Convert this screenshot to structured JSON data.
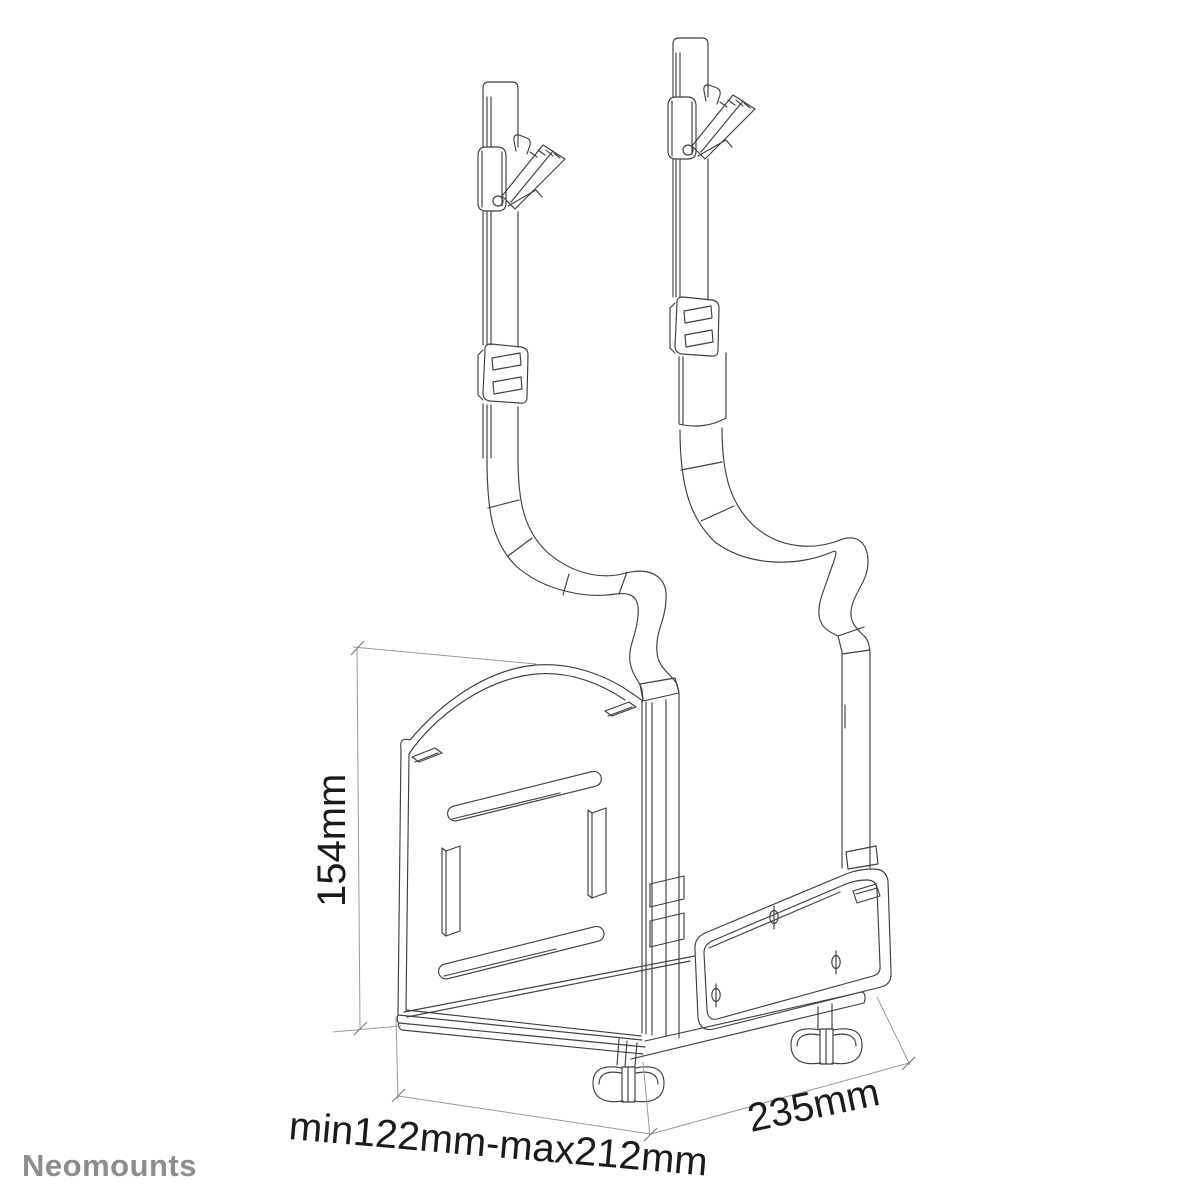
{
  "canvas": {
    "background": "#ffffff",
    "line_color": "#3f3f3f",
    "dim_line_color": "#9a9a9a",
    "dim_text_color": "#1b1b1b"
  },
  "drawing": {
    "dims": {
      "height": {
        "label": "154mm"
      },
      "depth_range": {
        "label": "min122mm-max212mm"
      },
      "width": {
        "label": "235mm"
      }
    }
  },
  "logo": {
    "text": "Neomounts",
    "color": "#8d8d8d"
  }
}
